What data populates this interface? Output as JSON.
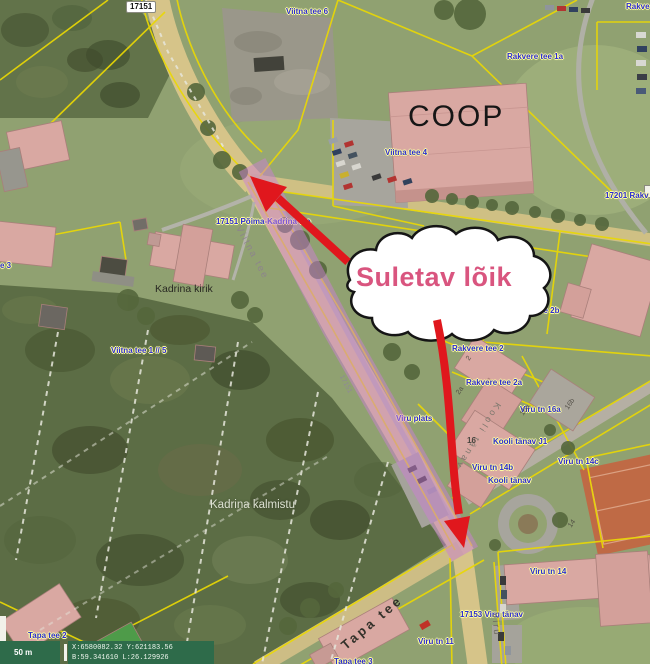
{
  "colors": {
    "accent-pink": "#d9557f",
    "arrow-red": "#e0171d",
    "closure": "#cb7fd4",
    "label-blue": "#2b2bd4",
    "halo": "#ffffa0",
    "roof": "#d9a8a2",
    "road": "#d6c489",
    "court": "#bf6a45",
    "sbar": "#2e6b4a"
  },
  "annotation": {
    "closed_section_label": "Suletav lõik"
  },
  "road_badge": {
    "text": "17151"
  },
  "labels": [
    "Viitna tee 6",
    "Rakve",
    "Rakvere tee 1a",
    "Viitna tee 4",
    "17201 Rakv",
    "17151 Põima-Kadrina tee",
    "e 3",
    "Viitna tee 1 // 5",
    "Rakvere tee 2b",
    "Rakvere tee 2",
    "Rakvere tee 2a",
    "Viru tn 16a",
    "Viru plats",
    "Kooli tänav J1",
    "Viru tn 14b",
    "Kooli tänav",
    "Viru tn 14c",
    "Viru tn 14",
    "17153 Viru tänav",
    "Viru tn 11",
    "Tapa tee 2",
    "Tapa tee 3"
  ],
  "map_texts": {
    "coop": "COOP",
    "church": "Kadrina kirik",
    "cemetery": "Kadrina kalmistu",
    "road_tapa": "Tapa tee",
    "road_viitna": "Viitna tee",
    "road_kooli": "Kooli tänav",
    "road_viru": "Viru",
    "road_ref_small": "17151"
  },
  "parcels": [
    "2",
    "2a",
    "16a",
    "16b",
    "14",
    "16"
  ],
  "statusbar": {
    "scale": "50 m",
    "coords_xy": "X:6580082.32 Y:621183.56",
    "coords_bl": "B:59.341610 L:26.129926"
  }
}
